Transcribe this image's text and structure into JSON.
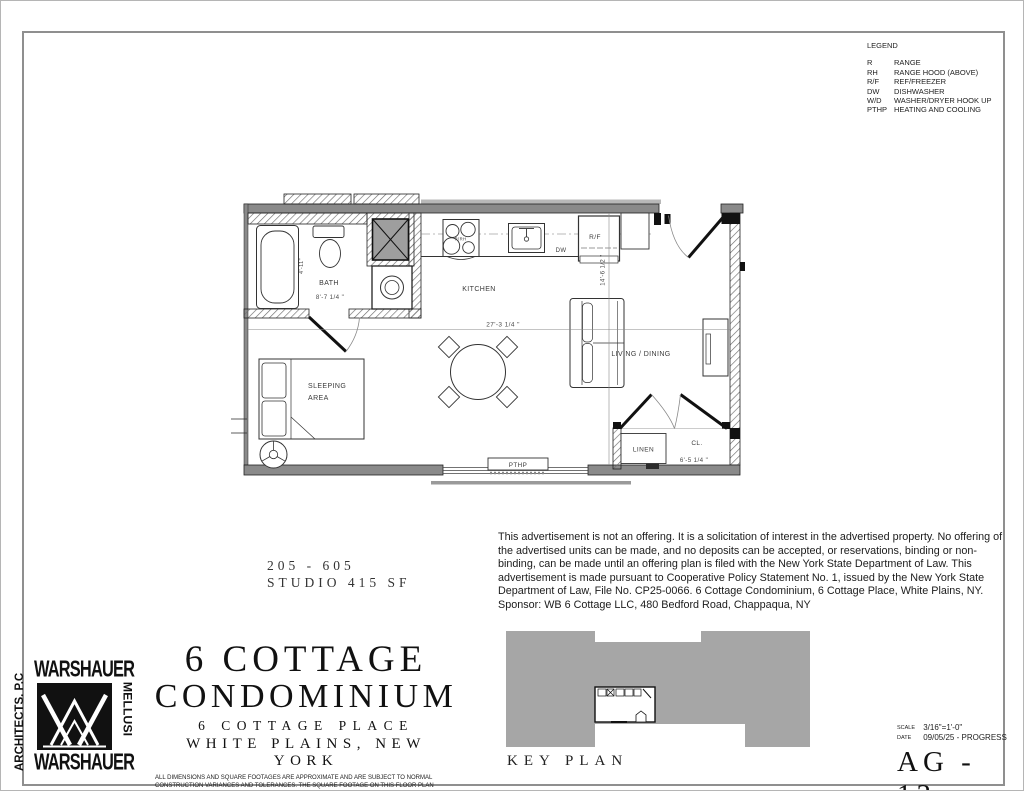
{
  "legend": {
    "title": "LEGEND",
    "items": [
      {
        "abbr": "R",
        "label": "RANGE"
      },
      {
        "abbr": "RH",
        "label": "RANGE HOOD (ABOVE)"
      },
      {
        "abbr": "R/F",
        "label": "REF/FREEZER"
      },
      {
        "abbr": "DW",
        "label": "DISHWASHER"
      },
      {
        "abbr": "W/D",
        "label": "WASHER/DRYER HOOK UP"
      },
      {
        "abbr": "PTHP",
        "label": "HEATING AND COOLING"
      }
    ]
  },
  "plan": {
    "rooms": {
      "bath": "BATH",
      "kitchen": "KITCHEN",
      "living": "LIVING / DINING",
      "sleeping_line1": "SLEEPING",
      "sleeping_line2": "AREA",
      "closet": "CL.",
      "linen": "LINEN"
    },
    "appliances": {
      "range": "R/RH",
      "dishwasher": "DW",
      "fridge": "R/F",
      "pthp": "PTHP"
    },
    "dimensions": {
      "bath_depth": "4'-11\"",
      "bath_width": "8'-7 1/4 \"",
      "unit_width": "27'-3 1/4 \"",
      "unit_depth": "14'-6 1/2 \"",
      "closet_width": "6'-5 1/4 \""
    }
  },
  "unit_info": {
    "unit_numbers": "205 - 605",
    "unit_type": "STUDIO 415 SF"
  },
  "disclaimer": "This advertisement is not an offering.  It is a solicitation of interest in the advertised property. No offering of the advertised units can be made, and no deposits can be accepted, or reservations, binding or non-binding, can be made until an offering plan is filed with the New York State Department of Law.  This advertisement is made pursuant to Cooperative Policy Statement No. 1, issued by the New York State Department of Law, File No. CP25-0066. 6 Cottage Condominium, 6 Cottage Place, White Plains, NY. Sponsor: WB 6 Cottage LLC, 480 Bedford Road, Chappaqua, NY",
  "title_block": {
    "project_line1": "6 COTTAGE",
    "project_line2": "CONDOMINIUM",
    "address_line1": "6 COTTAGE PLACE",
    "address_line2": "WHITE PLAINS, NEW YORK",
    "fine_print": "ALL DIMENSIONS AND SQUARE FOOTAGES ARE APPROXIMATE AND ARE SUBJECT TO NORMAL CONSTRUCTION VARIANCES AND TOLERANCES.  THE SQUARE FOOTAGE ON THIS FLOOR PLAN EXCEED THE USABLE FLOOR AREA. PLANS AND DIMENSIONS MAY CONTAIN MINOR VARIATIONS FROM FLOOR TO FLOOR. SPONSOR RESERVES THE RIGHT TO MAKE CHANGES IN ACCORDANCE WITH THE OFFERING PLAN."
  },
  "key_plan": {
    "label": "KEY PLAN"
  },
  "logo": {
    "top": "WARSHAUER",
    "right": "MELLUSI",
    "bottom": "WARSHAUER",
    "left": "ARCHITECTS. P.C"
  },
  "drawing_info": {
    "scale_label": "SCALE",
    "scale": "3/16\"=1'-0\"",
    "date_label": "DATE",
    "date": "09/05/25 - PROGRESS",
    "number": "AG - 13",
    "number_label": "DRAWING NUMBER"
  },
  "colors": {
    "wall_gray": "#8a8a8a",
    "keyplan_gray": "#a6a6a6",
    "line_dark": "#1a1a1a"
  }
}
